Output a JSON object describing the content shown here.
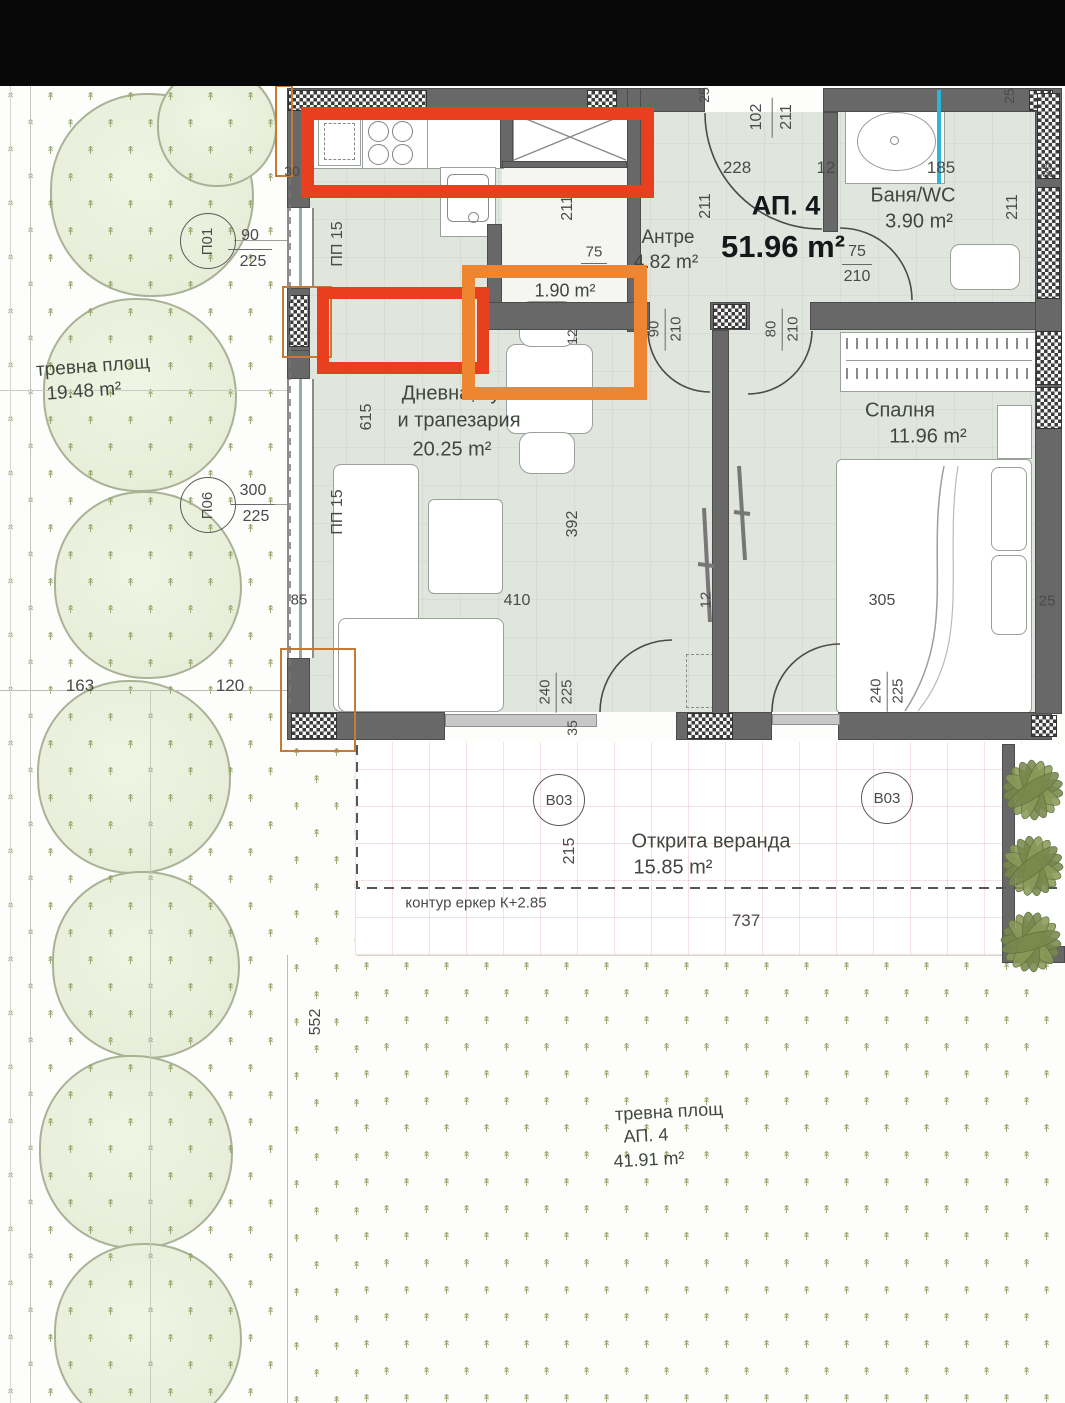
{
  "drawing": {
    "type": "apartment floor plan with landscaped site",
    "language": "Bulgarian"
  },
  "apartment": {
    "id": "АП. 4",
    "total_area": "51.96 m²"
  },
  "rooms": [
    {
      "name": "Антре",
      "area": "4.82 m²"
    },
    {
      "name": "Баня/WC",
      "area": "3.90 m²"
    },
    {
      "name": "Дневна, кухня и трапезария",
      "area": "20.25 m²"
    },
    {
      "name": "Спалня",
      "area": "11.96 m²"
    },
    {
      "name": "Открита веранда",
      "area": "15.85 m²"
    },
    {
      "name": "Склад (highlighted)",
      "area": "1.90 m²"
    }
  ],
  "site_labels": [
    {
      "name": "тревна площ",
      "area": "19.48 m²"
    },
    {
      "name": "тревна площ",
      "sub": "АП. 4",
      "area": "41.91 m²"
    }
  ],
  "note": "контур еркер К+2.85",
  "colors": {
    "annotation_red": "#e8401f",
    "annotation_orange": "#ee8631",
    "wall_gray": "#686868",
    "floor_sage": "#e0e6dd",
    "grass_glyph": "#93a368",
    "pipe_cyan": "#2ab6d9",
    "leaf_green": "#7f8f54"
  },
  "window_tags": [
    {
      "id": "П01",
      "x": 207,
      "y": 240,
      "rot": -90,
      "dim_top": "90",
      "dim_bot": "225",
      "dx": 250,
      "dy": 249
    },
    {
      "id": "П06",
      "x": 207,
      "y": 504,
      "rot": -90,
      "dim_top": "300",
      "dim_bot": "225",
      "dx": 253,
      "dy": 504
    },
    {
      "id": "В03",
      "x": 558,
      "y": 799
    },
    {
      "id": "В03",
      "x": 886,
      "y": 797
    }
  ],
  "text_labels": [
    {
      "t": "АП. 4",
      "x": 786,
      "y": 206,
      "fs": 27,
      "cls": "title"
    },
    {
      "t": "51.96 m²",
      "x": 783,
      "y": 247,
      "fs": 31,
      "cls": "title"
    },
    {
      "t": "Антре",
      "x": 668,
      "y": 238,
      "fs": 19,
      "cls": "room"
    },
    {
      "t": "4.82 m²",
      "x": 666,
      "y": 263,
      "fs": 19,
      "cls": "room"
    },
    {
      "t": "Баня/WC",
      "x": 913,
      "y": 196,
      "fs": 20,
      "cls": "room"
    },
    {
      "t": "3.90 m²",
      "x": 919,
      "y": 222,
      "fs": 20,
      "cls": "room"
    },
    {
      "t": "1.90 m²",
      "x": 565,
      "y": 291,
      "fs": 18,
      "cls": "room"
    },
    {
      "t": "Дневна, кухня",
      "x": 467,
      "y": 394,
      "fs": 20,
      "cls": "room"
    },
    {
      "t": "и трапезария",
      "x": 459,
      "y": 421,
      "fs": 20,
      "cls": "room"
    },
    {
      "t": "20.25 m²",
      "x": 452,
      "y": 450,
      "fs": 20,
      "cls": "room"
    },
    {
      "t": "Спалня",
      "x": 900,
      "y": 411,
      "fs": 20,
      "cls": "room"
    },
    {
      "t": "11.96 m²",
      "x": 928,
      "y": 437,
      "fs": 20,
      "cls": "room"
    },
    {
      "t": "Открита веранда",
      "x": 711,
      "y": 842,
      "fs": 20,
      "cls": "room"
    },
    {
      "t": "15.85 m²",
      "x": 673,
      "y": 868,
      "fs": 20,
      "cls": "room"
    },
    {
      "t": "контур еркер К+2.85",
      "x": 476,
      "y": 903,
      "fs": 15,
      "cls": "dim"
    },
    {
      "t": "тревна площ",
      "x": 93,
      "y": 367,
      "fs": 19,
      "cls": "room",
      "rot": -4
    },
    {
      "t": "19.48 m²",
      "x": 84,
      "y": 392,
      "fs": 19,
      "cls": "room",
      "rot": -4
    },
    {
      "t": "тревна площ",
      "x": 669,
      "y": 1112,
      "fs": 18,
      "cls": "room",
      "rot": -3
    },
    {
      "t": "АП. 4",
      "x": 646,
      "y": 1136,
      "fs": 18,
      "cls": "room",
      "rot": -3
    },
    {
      "t": "41.91 m²",
      "x": 649,
      "y": 1160,
      "fs": 18,
      "cls": "room",
      "rot": -3
    }
  ],
  "dim_labels": [
    {
      "t": "30",
      "x": 292,
      "y": 171,
      "fs": 14
    },
    {
      "t": "228",
      "x": 737,
      "y": 168,
      "fs": 17
    },
    {
      "t": "12",
      "x": 826,
      "y": 168,
      "fs": 17
    },
    {
      "t": "185",
      "x": 941,
      "y": 168,
      "fs": 17
    },
    {
      "t": "102",
      "x": 757,
      "y": 117,
      "rot": -90,
      "fs": 16
    },
    {
      "t": "211",
      "x": 787,
      "y": 117,
      "rot": -90,
      "fs": 16
    },
    {
      "t": "25",
      "x": 704,
      "y": 95,
      "rot": -90,
      "fs": 14
    },
    {
      "t": "25",
      "x": 1009,
      "y": 96,
      "rot": -90,
      "fs": 14
    },
    {
      "t": "25",
      "x": 1047,
      "y": 170,
      "rot": -90,
      "fs": 14
    },
    {
      "t": "211",
      "x": 1013,
      "y": 207,
      "rot": -90,
      "fs": 16
    },
    {
      "t": "75",
      "x": 857,
      "y": 252,
      "fs": 16
    },
    {
      "t": "210",
      "x": 857,
      "y": 277,
      "fs": 16
    },
    {
      "t": "211",
      "x": 706,
      "y": 206,
      "rot": -90,
      "fs": 16
    },
    {
      "t": "211",
      "x": 568,
      "y": 208,
      "rot": -90,
      "fs": 16
    },
    {
      "t": "75",
      "x": 594,
      "y": 252,
      "fs": 15
    },
    {
      "t": "12",
      "x": 572,
      "y": 337,
      "rot": -90,
      "fs": 14
    },
    {
      "t": "90",
      "x": 654,
      "y": 329,
      "rot": -90,
      "fs": 15
    },
    {
      "t": "210",
      "x": 676,
      "y": 329,
      "rot": -90,
      "fs": 15
    },
    {
      "t": "80",
      "x": 771,
      "y": 329,
      "rot": -90,
      "fs": 15
    },
    {
      "t": "210",
      "x": 793,
      "y": 329,
      "rot": -90,
      "fs": 15
    },
    {
      "t": "ПП 15",
      "x": 338,
      "y": 244,
      "rot": -90,
      "fs": 16
    },
    {
      "t": "ПП 15",
      "x": 338,
      "y": 512,
      "rot": -90,
      "fs": 16
    },
    {
      "t": "615",
      "x": 367,
      "y": 417,
      "rot": -90,
      "fs": 16
    },
    {
      "t": "392",
      "x": 573,
      "y": 524,
      "rot": -90,
      "fs": 16
    },
    {
      "t": "410",
      "x": 517,
      "y": 601,
      "fs": 16
    },
    {
      "t": "85",
      "x": 299,
      "y": 600,
      "fs": 15
    },
    {
      "t": "163",
      "x": 80,
      "y": 686,
      "fs": 17
    },
    {
      "t": "120",
      "x": 230,
      "y": 686,
      "fs": 17
    },
    {
      "t": "305",
      "x": 882,
      "y": 601,
      "fs": 16
    },
    {
      "t": "12",
      "x": 706,
      "y": 600,
      "rot": -90,
      "fs": 15
    },
    {
      "t": "25",
      "x": 1047,
      "y": 601,
      "fs": 15
    },
    {
      "t": "240",
      "x": 545,
      "y": 692,
      "rot": -90,
      "fs": 15
    },
    {
      "t": "225",
      "x": 567,
      "y": 692,
      "rot": -90,
      "fs": 15
    },
    {
      "t": "35",
      "x": 572,
      "y": 728,
      "rot": -90,
      "fs": 14
    },
    {
      "t": "240",
      "x": 876,
      "y": 691,
      "rot": -90,
      "fs": 15
    },
    {
      "t": "225",
      "x": 898,
      "y": 691,
      "rot": -90,
      "fs": 15
    },
    {
      "t": "215",
      "x": 570,
      "y": 851,
      "rot": -90,
      "fs": 16
    },
    {
      "t": "737",
      "x": 746,
      "y": 921,
      "fs": 17
    },
    {
      "t": "552",
      "x": 316,
      "y": 1022,
      "rot": -90,
      "fs": 16
    }
  ]
}
